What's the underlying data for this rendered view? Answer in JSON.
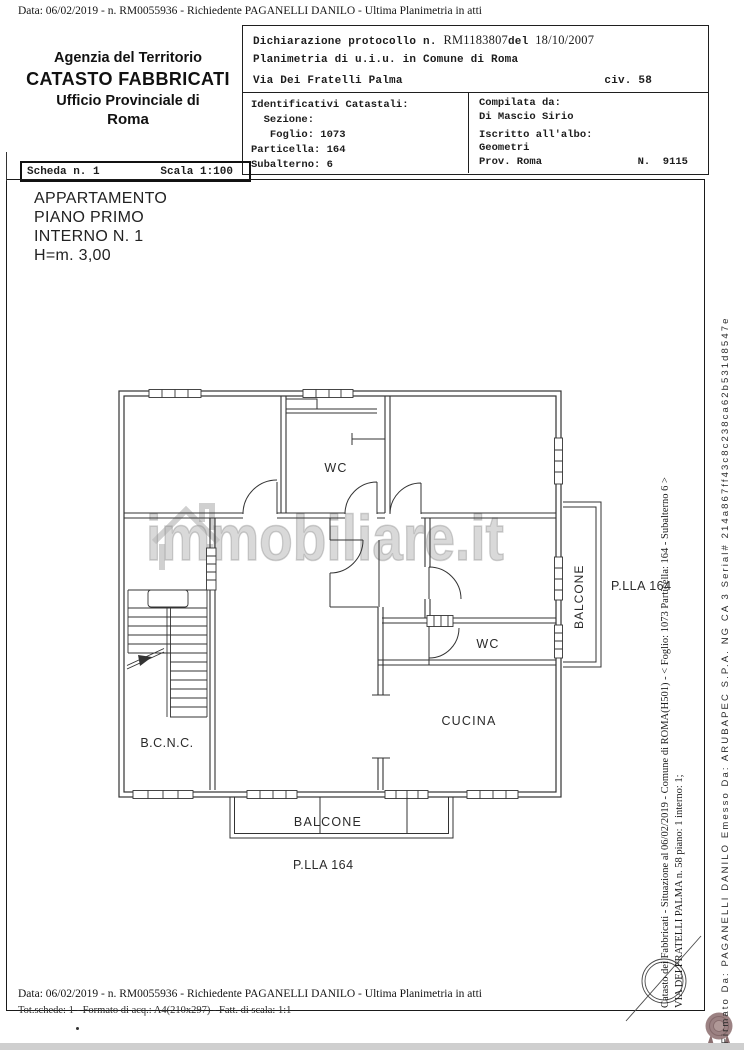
{
  "page": {
    "top_line": "Data: 06/02/2019 -  n. RM0055936 - Richiedente PAGANELLI DANILO - Ultima Planimetria in atti",
    "footer_line1": "Data: 06/02/2019 -  n. RM0055936 - Richiedente PAGANELLI DANILO - Ultima Planimetria in atti",
    "footer_line2": "Tot.schede: 1 - Formato di acq.: A4(210x297) - Fatt. di scala: 1:1"
  },
  "agency": {
    "line1": "Agenzia del Territorio",
    "line2": "CATASTO FABBRICATI",
    "line3": "Ufficio Provinciale di",
    "line4": "Roma"
  },
  "declaration": {
    "protocol_label": "Dichiarazione protocollo n. ",
    "protocol_number": "RM1183807",
    "del_label": "del ",
    "date": "18/10/2007",
    "line2": "Planimetria di u.i.u. in Comune di Roma",
    "street": "Via Dei Fratelli Palma",
    "civ": "civ. 58"
  },
  "identificativi": {
    "title": "Identificativi Catastali:",
    "sezione": "  Sezione:",
    "foglio": "   Foglio: 1073",
    "particella": "Particella: 164",
    "subalterno": "Subalterno: 6"
  },
  "compilata": {
    "label": "Compilata da:",
    "name": "Di Mascio Sirio",
    "albo_label": "Iscritto all'albo:",
    "albo_value": "Geometri",
    "prov": "Prov. Roma",
    "numero": "N.  9115"
  },
  "scheda": {
    "scheda": "Scheda n. 1",
    "scala": "Scala 1:100"
  },
  "title_block": {
    "line1": "APPARTAMENTO",
    "line2": "PIANO PRIMO",
    "line3": "INTERNO N. 1",
    "line4": "H=m. 3,00"
  },
  "plan_labels": {
    "wc_top": "WC",
    "wc_bottom": "WC",
    "cucina": "CUCINA",
    "bcnc": "B.C.N.C.",
    "balcone_right": "BALCONE",
    "balcone_bottom": "BALCONE",
    "plla_right": "P.LLA 164",
    "plla_bottom": "P.LLA 164"
  },
  "watermark": {
    "text": "immobiliare.it"
  },
  "margin_texts": {
    "catasto": "Catasto dei Fabbricati - Situazione al 06/02/2019 - Comune di ROMA(H501) - < Foglio: 1073 Particella: 164 - Subalterno 6 >",
    "via": "VIA DEI FRATELLI PALMA n. 58 piano: 1 interno: 1;",
    "firmato": "Firmato Da: PAGANELLI DANILO Emesso Da: ARUBAPEC S.P.A. NG CA 3 Serial# 214a867ff43c8c238ca62b531d8547e"
  },
  "colors": {
    "ink": "#2e2e2e",
    "seal_body": "#9c8283",
    "seal_ribbon": "#8b6f70"
  }
}
